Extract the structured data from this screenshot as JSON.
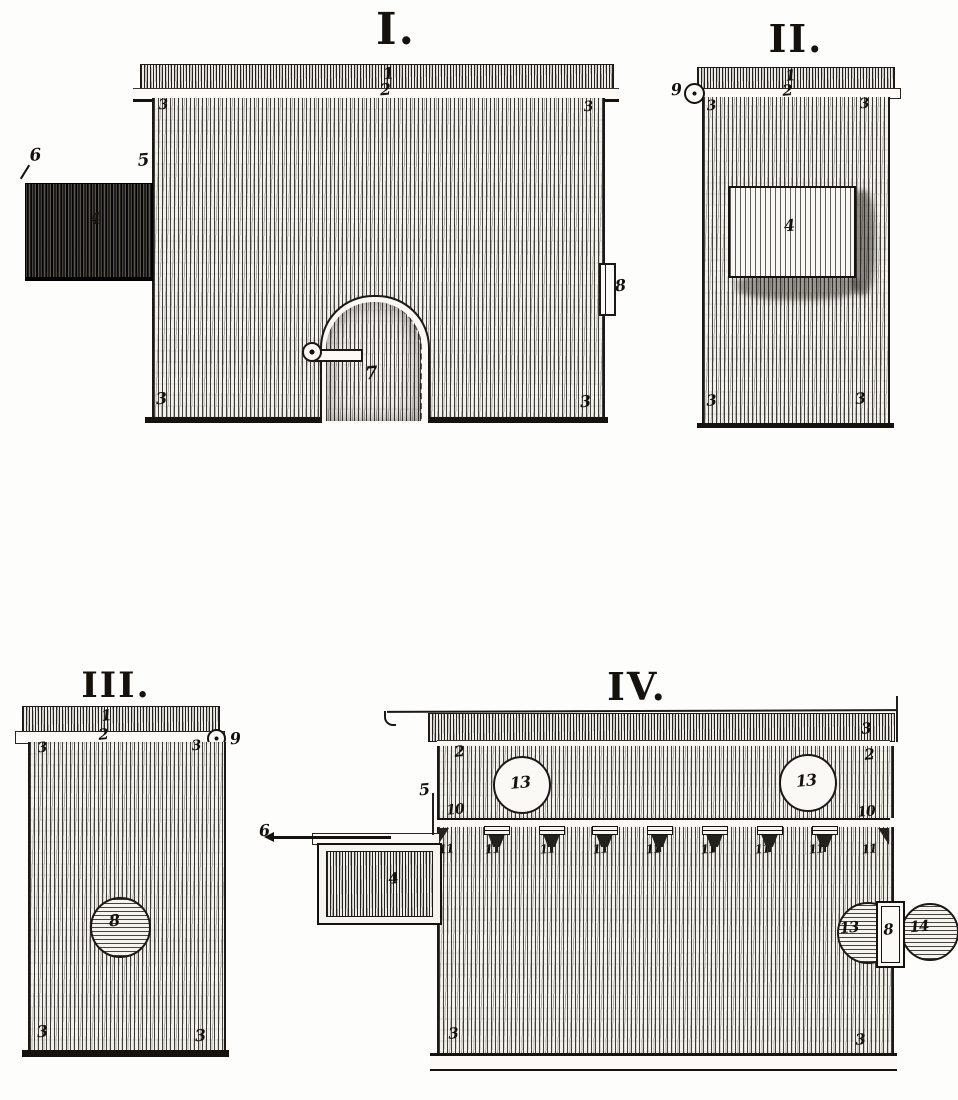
{
  "plate": {
    "paper_color": "#fdfdfb",
    "ink_color": "#16130f",
    "description": "Engraved plate of four numbered views (I-IV) of a wooden box apparatus with drawers, rods, arched door and knobs"
  },
  "figures": {
    "fig1": {
      "title": "I.",
      "labels": [
        {
          "t": "1",
          "x": 388,
          "y": 74,
          "s": 16
        },
        {
          "t": "2",
          "x": 385,
          "y": 90,
          "s": 16
        },
        {
          "t": "3",
          "x": 163,
          "y": 105,
          "s": 14
        },
        {
          "t": "3",
          "x": 588,
          "y": 107,
          "s": 14
        },
        {
          "t": "3",
          "x": 161,
          "y": 399,
          "s": 16
        },
        {
          "t": "3",
          "x": 585,
          "y": 402,
          "s": 16
        },
        {
          "t": "6",
          "x": 35,
          "y": 156,
          "s": 17
        },
        {
          "t": "5",
          "x": 143,
          "y": 161,
          "s": 17
        },
        {
          "t": "4",
          "x": 95,
          "y": 219,
          "s": 16
        },
        {
          "t": "7",
          "x": 371,
          "y": 374,
          "s": 18
        },
        {
          "t": "8",
          "x": 620,
          "y": 286,
          "s": 16
        }
      ]
    },
    "fig2": {
      "title": "II.",
      "labels": [
        {
          "t": "9",
          "x": 676,
          "y": 90,
          "s": 16
        },
        {
          "t": "1",
          "x": 790,
          "y": 76,
          "s": 15
        },
        {
          "t": "2",
          "x": 787,
          "y": 91,
          "s": 15
        },
        {
          "t": "3",
          "x": 711,
          "y": 106,
          "s": 14
        },
        {
          "t": "3",
          "x": 864,
          "y": 104,
          "s": 14
        },
        {
          "t": "4",
          "x": 789,
          "y": 226,
          "s": 16
        },
        {
          "t": "3",
          "x": 711,
          "y": 401,
          "s": 15
        },
        {
          "t": "3",
          "x": 860,
          "y": 399,
          "s": 15
        }
      ]
    },
    "fig3": {
      "title": "III.",
      "labels": [
        {
          "t": "1",
          "x": 106,
          "y": 716,
          "s": 15
        },
        {
          "t": "2",
          "x": 103,
          "y": 735,
          "s": 15
        },
        {
          "t": "9",
          "x": 235,
          "y": 739,
          "s": 16
        },
        {
          "t": "3",
          "x": 42,
          "y": 748,
          "s": 14
        },
        {
          "t": "3",
          "x": 196,
          "y": 746,
          "s": 14
        },
        {
          "t": "8",
          "x": 114,
          "y": 921,
          "s": 16
        },
        {
          "t": "3",
          "x": 42,
          "y": 1032,
          "s": 16
        },
        {
          "t": "3",
          "x": 200,
          "y": 1036,
          "s": 16
        }
      ]
    },
    "fig4": {
      "title": "IV.",
      "labels": [
        {
          "t": "3",
          "x": 866,
          "y": 729,
          "s": 15
        },
        {
          "t": "2",
          "x": 459,
          "y": 752,
          "s": 15
        },
        {
          "t": "2",
          "x": 869,
          "y": 755,
          "s": 15
        },
        {
          "t": "5",
          "x": 424,
          "y": 790,
          "s": 16
        },
        {
          "t": "13",
          "x": 520,
          "y": 783,
          "s": 16
        },
        {
          "t": "13",
          "x": 806,
          "y": 781,
          "s": 16
        },
        {
          "t": "10",
          "x": 455,
          "y": 810,
          "s": 14
        },
        {
          "t": "10",
          "x": 866,
          "y": 812,
          "s": 14
        },
        {
          "t": "11",
          "x": 446,
          "y": 849,
          "s": 12
        },
        {
          "t": "11",
          "x": 492,
          "y": 849,
          "s": 12
        },
        {
          "t": "11",
          "x": 547,
          "y": 849,
          "s": 12
        },
        {
          "t": "11",
          "x": 600,
          "y": 849,
          "s": 12
        },
        {
          "t": "11",
          "x": 653,
          "y": 849,
          "s": 12
        },
        {
          "t": "11",
          "x": 708,
          "y": 849,
          "s": 12
        },
        {
          "t": "11",
          "x": 762,
          "y": 849,
          "s": 12
        },
        {
          "t": "11",
          "x": 816,
          "y": 849,
          "s": 12
        },
        {
          "t": "11",
          "x": 869,
          "y": 849,
          "s": 12
        },
        {
          "t": "6",
          "x": 264,
          "y": 831,
          "s": 16
        },
        {
          "t": "4",
          "x": 393,
          "y": 879,
          "s": 15
        },
        {
          "t": "13",
          "x": 849,
          "y": 928,
          "s": 15
        },
        {
          "t": "8",
          "x": 888,
          "y": 930,
          "s": 15
        },
        {
          "t": "14",
          "x": 919,
          "y": 927,
          "s": 15
        },
        {
          "t": "3",
          "x": 453,
          "y": 1034,
          "s": 15
        },
        {
          "t": "3",
          "x": 860,
          "y": 1040,
          "s": 15
        }
      ],
      "funnels": {
        "label": "11",
        "x_centers": [
          497,
          552,
          605,
          660,
          715,
          770,
          825
        ]
      }
    }
  }
}
